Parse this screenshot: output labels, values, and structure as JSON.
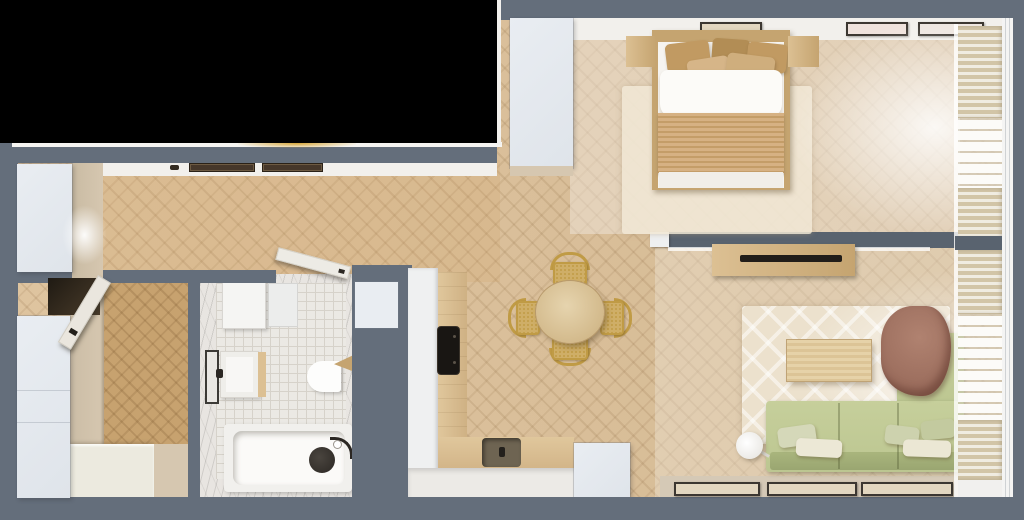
{
  "scene": {
    "kind": "top-down 3d render of an apartment floor plan",
    "has_blacked_out_region": true,
    "text_content": "none"
  },
  "palette": {
    "black": "#000000",
    "wall": "#646e7b",
    "wall_deep": "#59636f",
    "white_band": "#f2f0ec",
    "cabinet_white": "#e9edf2",
    "beige": "#d6c7b0",
    "floor_wood": "#dcc099",
    "floor_entry": "#c7a26f",
    "wood": "#dcc093",
    "wood_dark": "#c5a470",
    "dark_fixture": "#2b2723",
    "tile": "#ebe9e4",
    "tile_grout": "#d6d2ca",
    "marble": "#e8e5e1",
    "sofa_green": "#bcc691",
    "sofa_green_deep": "#a9b57d",
    "blanket_tan": "#cdaa79",
    "throw_brown": "#9a6c5c",
    "duvet_white": "#f6f4f0",
    "blind_beige": "#d2c5a7",
    "sheer_white": "#fcfbf8",
    "chair_gold": "#c09b45",
    "cane_seat": "#cfae67",
    "glow_gold": "#d8a93f"
  },
  "rooms": {
    "hallway_kitchen": {
      "items": [
        "hallway-cabinet",
        "wall-niches",
        "kitchen-counter",
        "cooktop",
        "kitchen-sink",
        "kitchen-cabinets",
        "duct-shaft"
      ]
    },
    "entry_closet": {
      "items": [
        "wardrobe",
        "bench",
        "open-door",
        "doorway-shadow"
      ]
    },
    "bathroom": {
      "items": [
        "washing-machine",
        "cabinet",
        "mirror",
        "sink",
        "toilet",
        "wood-shelf",
        "bathtub",
        "shower-head",
        "shower-hose",
        "open-door"
      ]
    },
    "bedroom": {
      "items": [
        "wardrobe",
        "double-bed",
        "pillows-5",
        "duvet",
        "blanket",
        "nightstand-left",
        "nightstand-right",
        "rug",
        "wall-art-3",
        "window-blinds"
      ]
    },
    "dining": {
      "items": [
        "round-table",
        "cane-chairs-4"
      ]
    },
    "living": {
      "items": [
        "tv-console",
        "tv",
        "rug",
        "coffee-table",
        "corner-sofa",
        "back-cushions",
        "throw-blanket",
        "sofa-pillows-5",
        "floor-lamp",
        "leaning-artworks-3",
        "window-ledge",
        "window-blinds"
      ]
    }
  }
}
